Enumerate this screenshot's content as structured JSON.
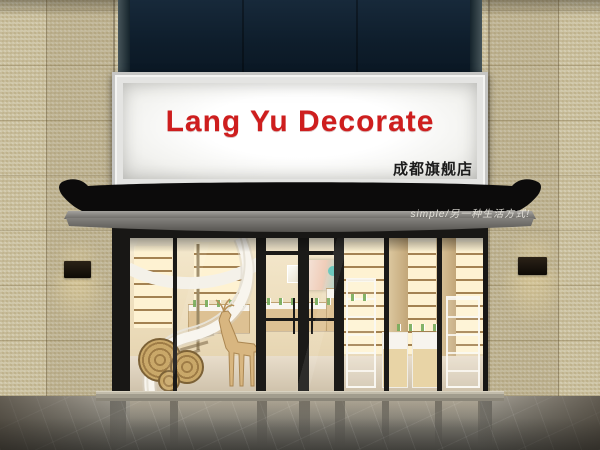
{
  "scene": {
    "description": "3D architectural render of a cosmetics shop storefront with illuminated signboard, black awning, glass facade, spiral staircase and product shelving"
  },
  "signboard": {
    "title": "Lang Yu Decorate",
    "title_color": "#ce1e1e",
    "subtitle": "成都旗舰店",
    "subtitle_color": "#1c1c1c",
    "face_color": "#f7f7f4"
  },
  "awning": {
    "slogan": "simple/另一种生活方式!",
    "slogan_color": "#ece9e2",
    "canopy_color": "#0c0b0b",
    "valance_color": "#6f6d69"
  },
  "palette": {
    "tile_wall": "#cbc1a0",
    "top_panel": "#0e1d2b",
    "frame_black": "#181715",
    "interior_warm": "#eeddba",
    "wood": "#c8a76b",
    "product_green": "#9cc67e",
    "staircase_white": "#f7f5ee",
    "floor_gray": "#807d74",
    "lamp_glow": "#f5e2ae"
  }
}
